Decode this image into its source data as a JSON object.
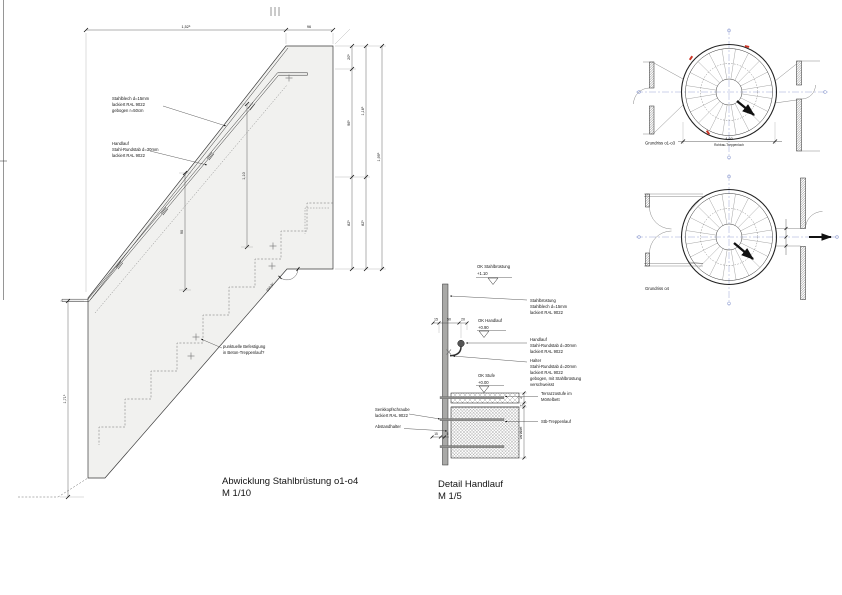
{
  "colors": {
    "paper": "#ffffff",
    "band_fill": "#f1f1ef",
    "accent_red": "#cd3526",
    "axis_blue": "#8191cc",
    "line": "#2e2e2e"
  },
  "dev": {
    "title": "Abwicklung Stahlbrüstung o1-o4",
    "scale": "M 1/10",
    "dim_top1": "1,52⁵",
    "dim_top2": "96",
    "c1a": "20⁵",
    "c1b": "96⁵",
    "c1c": "82⁵",
    "c2a": "1,16⁵",
    "c2b": "82⁵",
    "c3": "1,99⁵",
    "left": "1,71⁵",
    "h1": "1,10",
    "h2": "90",
    "angle": "100,9°",
    "sheet1": "Stahlblech d=15mm",
    "sheet2": "lackiert RAL 9022",
    "sheet3": "gebogen r=50cm",
    "hr1": "Handlauf",
    "hr2": "Stahl-Rundstab d=30mm",
    "hr3": "lackiert RAL 9022",
    "fix1": "punktuelle Befestigung",
    "fix2": "in Beton-Treppenlauf?"
  },
  "det": {
    "title": "Detail Handlauf",
    "scale": "M 1/5",
    "lvl1": "OK Stahlbrüstung",
    "lvl1v": "+1.10",
    "lvl2": "OK Handlauf",
    "lvl2v": "+0.90",
    "lvl3": "OK Stufe",
    "lvl3v": "+0.00",
    "br1": "Stahlbrüstung",
    "br2": "Stahlblech d=15mm",
    "br3": "lackiert RAL 9022",
    "ha1": "Handlauf",
    "ha2": "Stahl-Rundstab d=30mm",
    "ha3": "lackiert RAL 9022",
    "ht1": "Halter",
    "ht2": "Stahl-Rundstab d=20mm",
    "ht3": "lackiert RAL 9022",
    "ht4": "gebogen, mit Stahlbrüstung",
    "ht5": "verschweisst",
    "tz1": "Terrazzostufe im",
    "tz2": "Mörtelbett",
    "stb": "Stb-Treppenlauf",
    "sk1": "Senkkopfschraube",
    "sk2": "lackiert RAL 9022",
    "ab": "Abstandhalter",
    "d15": "15",
    "d50": "50",
    "d20": "20",
    "dl15": "15",
    "dl5": "5",
    "dr4": "4",
    "dr2": "2",
    "var": "variabel"
  },
  "plans": {
    "cap1": "Grundriss o1-o3",
    "dim": "4,60",
    "dimlabel": "Rohbau-Treppenloch",
    "cap2": "Grundriss o4"
  }
}
